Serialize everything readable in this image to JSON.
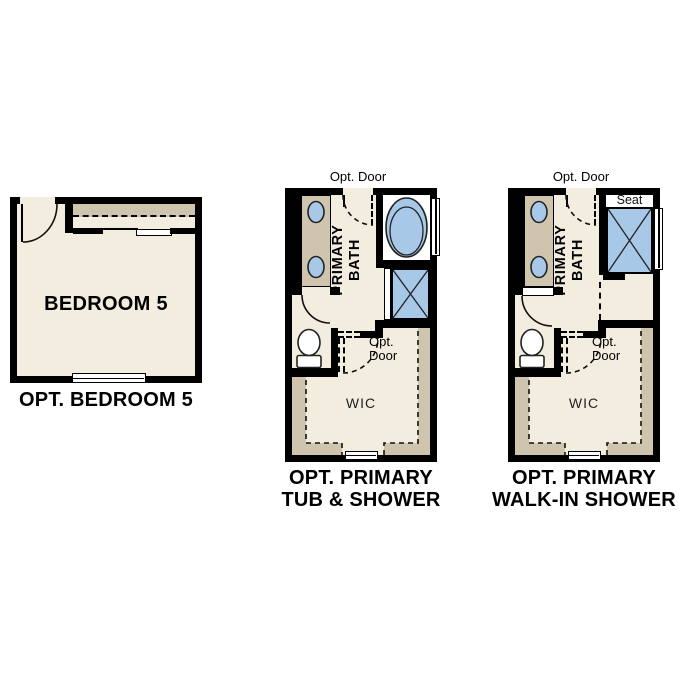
{
  "colors": {
    "wall": "#000000",
    "floor": "#f3ede0",
    "cabinet": "#cfc5ae",
    "fixture": "#a8c8e8",
    "white": "#ffffff"
  },
  "icons": {
    "tub": "tub-icon",
    "shower": "shower-x-icon",
    "toilet": "toilet-icon",
    "sink": "sink-icon",
    "door_swing": "door-swing-arc-icon",
    "window": "window-icon"
  },
  "bedroom": {
    "room_label": "BEDROOM 5",
    "caption": "OPT. BEDROOM 5"
  },
  "tub_shower": {
    "opt_door_top": "Opt. Door",
    "primary_line1": "PRIMARY",
    "primary_line2": "BATH",
    "opt_door_mid_line1": "Opt.",
    "opt_door_mid_line2": "Door",
    "wic_label": "WIC",
    "caption_line1": "OPT. PRIMARY",
    "caption_line2": "TUB & SHOWER"
  },
  "walkin_shower": {
    "opt_door_top": "Opt. Door",
    "seat_label": "Seat",
    "primary_line1": "PRIMARY",
    "primary_line2": "BATH",
    "opt_door_mid_line1": "Opt.",
    "opt_door_mid_line2": "Door",
    "wic_label": "WIC",
    "caption_line1": "OPT. PRIMARY",
    "caption_line2": "WALK-IN SHOWER"
  }
}
